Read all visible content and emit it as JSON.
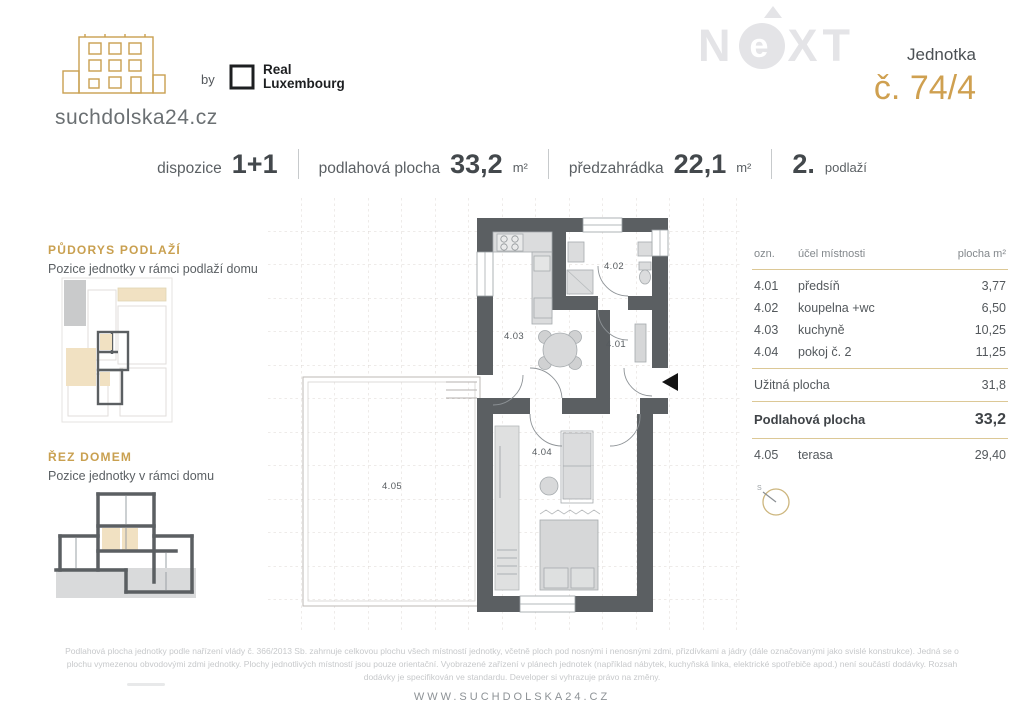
{
  "brand": {
    "site": "suchdolska24.cz",
    "by": "by",
    "partner_line1": "Real",
    "partner_line2": "Luxembourg",
    "watermark_n": "N",
    "watermark_e": "e",
    "watermark_xt": "XT"
  },
  "unit": {
    "label": "Jednotka",
    "number": "č. 74/4"
  },
  "specs": {
    "s0": {
      "label": "dispozice",
      "value": "1+1",
      "unit": ""
    },
    "s1": {
      "label": "podlahová plocha",
      "value": "33,2",
      "unit": "m²"
    },
    "s2": {
      "label": "předzahrádka",
      "value": "22,1",
      "unit": "m²"
    },
    "s3": {
      "label": "",
      "value": "2.",
      "unit": "podlaží"
    }
  },
  "sidebar": {
    "floorplan_title": "PŮDORYS PODLAŽÍ",
    "floorplan_sub": "Pozice jednotky v rámci podlaží domu",
    "section_title": "ŘEZ DOMEM",
    "section_sub": "Pozice jednotky v rámci domu"
  },
  "plan": {
    "rooms": {
      "r401": "4.01",
      "r402": "4.02",
      "r403": "4.03",
      "r404": "4.04",
      "r405": "4.05"
    }
  },
  "table": {
    "headers": {
      "ozn": "ozn.",
      "name": "účel místnosti",
      "area": "plocha m²"
    },
    "rows": [
      {
        "ozn": "4.01",
        "name": "předsíň",
        "area": "3,77"
      },
      {
        "ozn": "4.02",
        "name": "koupelna +wc",
        "area": "6,50"
      },
      {
        "ozn": "4.03",
        "name": "kuchyně",
        "area": "10,25"
      },
      {
        "ozn": "4.04",
        "name": "pokoj č. 2",
        "area": "11,25"
      }
    ],
    "usable": {
      "label": "Užitná plocha",
      "value": "31,8"
    },
    "floor": {
      "label": "Podlahová plocha",
      "value": "33,2"
    },
    "terrace": {
      "ozn": "4.05",
      "name": "terasa",
      "area": "29,40"
    },
    "compass": "S"
  },
  "footer": {
    "disclaimer": "Podlahová plocha jednotky podle nařízení vlády č. 366/2013 Sb. zahrnuje celkovou plochu všech místností jednotky, včetně ploch pod nosnými i nenosnými zdmi, přizdívkami a jádry (dále označovanými jako svislé konstrukce). Jedná se o plochu vymezenou obvodovými zdmi jednotky. Plochy jednotlivých místností jsou pouze orientační. Vyobrazené zařízení v plánech jednotek (například nábytek, kuchyňská linka, elektrické spotřebiče apod.) není součástí dodávky. Rozsah dodávky je specifikován ve standardu. Developer si vyhrazuje právo na změny.",
    "website": "WWW.SUCHDOLSKA24.CZ"
  },
  "colors": {
    "accent": "#c9a050",
    "wall": "#5b5f62",
    "beige": "#f1e1c2"
  }
}
